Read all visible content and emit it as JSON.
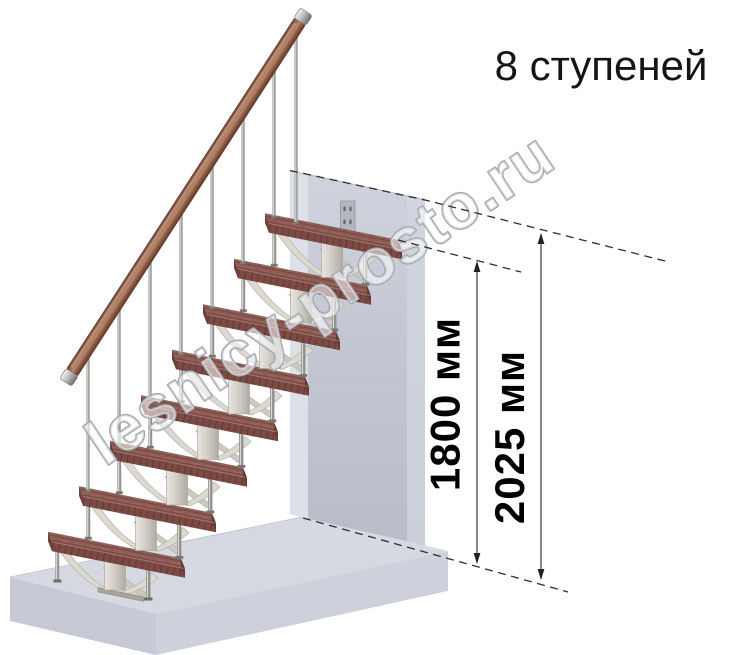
{
  "title": "8 ступеней",
  "watermark": "lesnicy-prosto.ru",
  "dimensions": {
    "height_to_top_step": "1800 мм",
    "height_total": "2025 мм"
  },
  "scene": {
    "steps_count": 8,
    "colors": {
      "tread": "#8d5b53",
      "tread_front": "#7b4a43",
      "handrail_wood": "#a4735f",
      "metal_rods": "#9a9a96",
      "spine": "#dcd9d1",
      "wall": "#c5c8d4",
      "floor": "#d6d9e2",
      "dimension_lines": "#3c3c3c",
      "text": "#111111"
    }
  }
}
